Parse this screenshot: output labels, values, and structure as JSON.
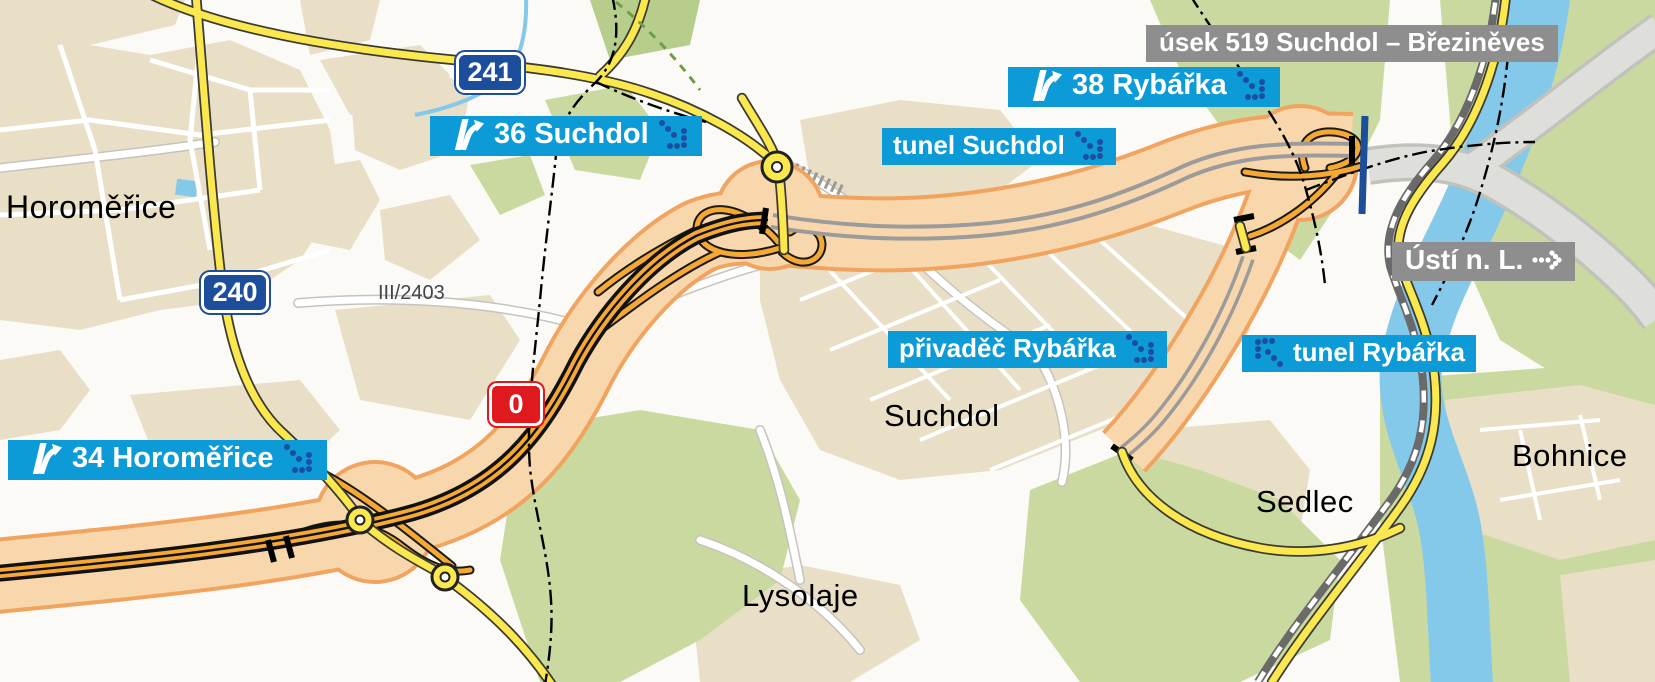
{
  "map": {
    "section_label": "úsek 519 Suchdol – Březiněves",
    "destination_label": "Ústí n. L.",
    "exits": {
      "e34": "34 Horoměřice",
      "e36": "36 Suchdol",
      "e38": "38 Rybářka"
    },
    "features": {
      "tunel_suchdol": "tunel Suchdol",
      "privadec_rybarka": "přivaděč Rybářka",
      "tunel_rybarka": "tunel Rybářka"
    },
    "road_numbers": {
      "r241": "241",
      "r240": "240",
      "ring": "0"
    },
    "road_ref": "III/2403",
    "places": {
      "horomerice": "Horoměřice",
      "suchdol": "Suchdol",
      "sedlec": "Sedlec",
      "bohnice": "Bohnice",
      "lysolaje": "Lysolaje"
    },
    "colors": {
      "label_blue": "#0d9bd8",
      "label_gray": "#8e8e8e",
      "badge_blue": "#1d4e9b",
      "badge_red": "#e0191f",
      "arrow_navy": "#1b4e9e",
      "corridor_fill": "#f9d7ad",
      "corridor_edge": "#f1a45f",
      "mainline_orange": "#f5a834",
      "road_yellow": "#fbe84e",
      "river_blue": "#85c9ea",
      "area_green": "#c9d9a0",
      "area_beige": "#e8dfc6",
      "tunnel_gray": "#9b9b9b"
    }
  }
}
